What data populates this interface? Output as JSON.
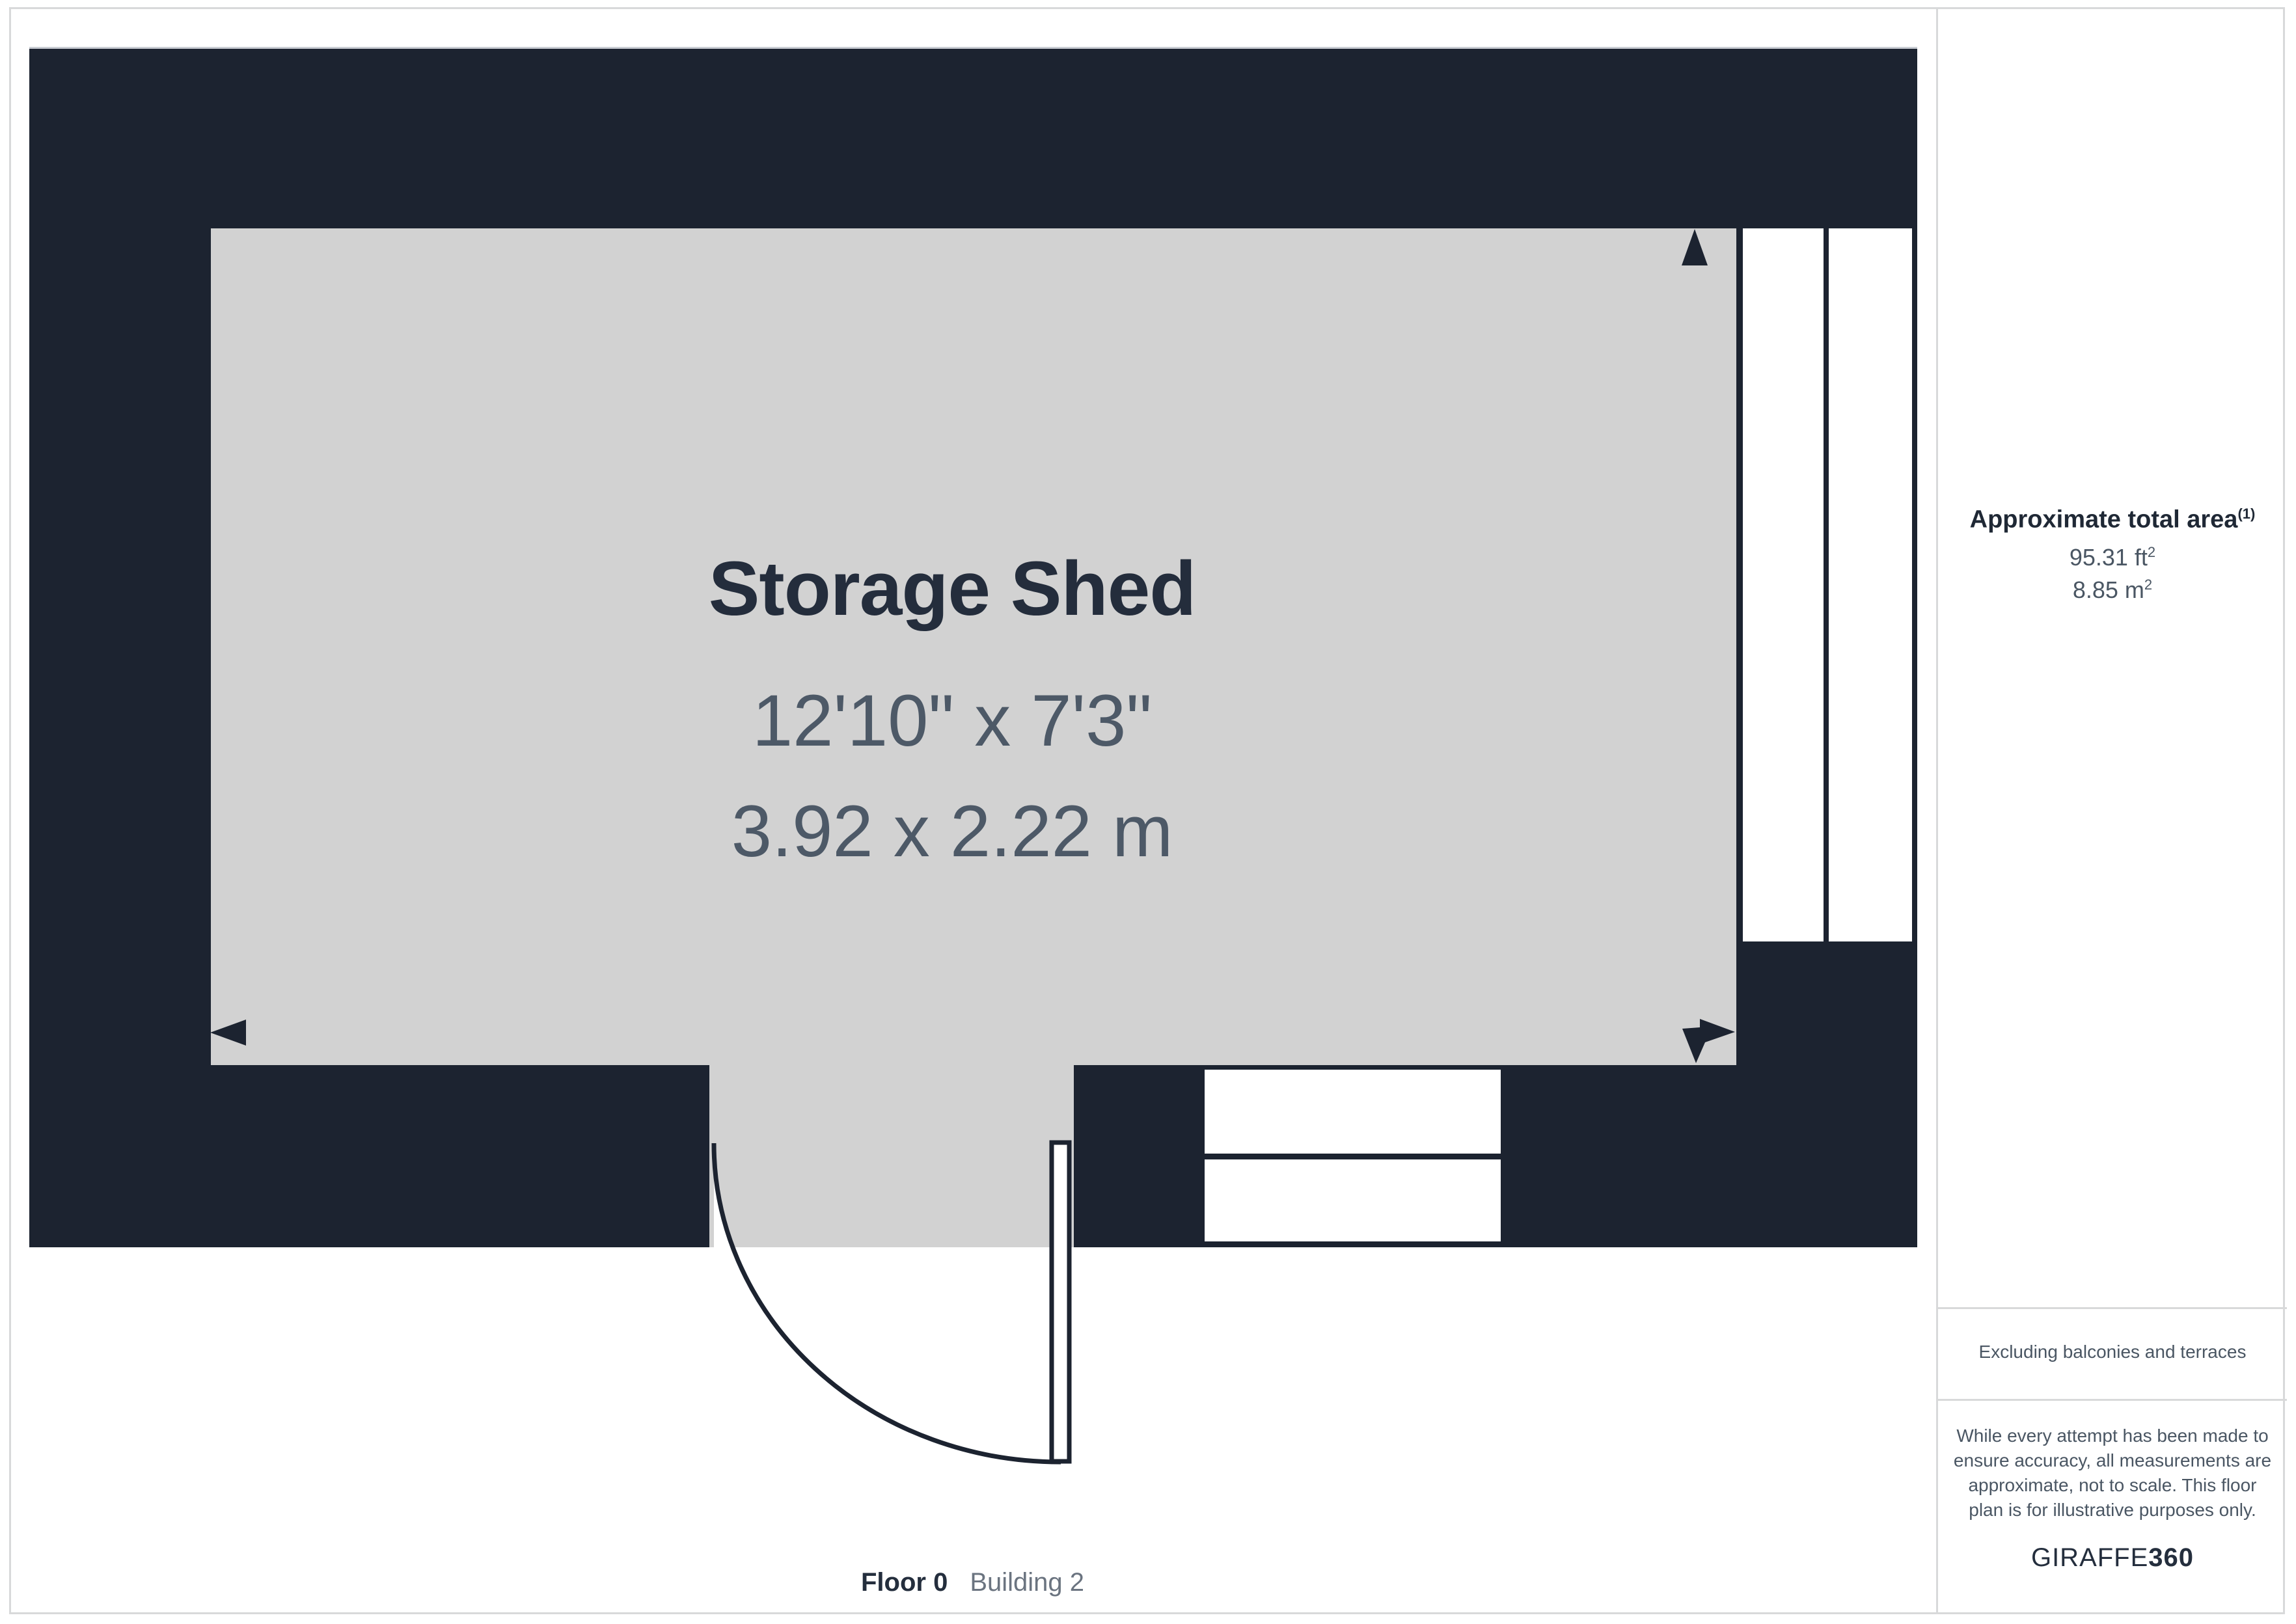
{
  "room": {
    "name": "Storage Shed",
    "size_imperial": "12'10\" x 7'3\"",
    "size_metric": "3.92 x 2.22 m"
  },
  "footer": {
    "floor": "Floor 0",
    "building": "Building 2"
  },
  "sidebar": {
    "area_title": "Approximate total area",
    "area_footnote_marker": "(1)",
    "area_imperial": "95.31 ft",
    "area_imperial_sup": "2",
    "area_metric": "8.85 m",
    "area_metric_sup": "2",
    "exclusion_note": "Excluding balconies and terraces",
    "disclaimer_lines": [
      "While every attempt has been made to",
      "ensure accuracy, all measurements are",
      "approximate, not to scale. This floor",
      "plan is for illustrative purposes only."
    ],
    "brand_name": "GIRAFFE",
    "brand_suffix": "360"
  },
  "colors": {
    "wall": "#1C2330",
    "floor_fill": "#D2D2D2",
    "frame_border": "#D8D9DA",
    "room_title_text": "#242D3C",
    "dimension_text": "#4D5967",
    "sidebar_heading_text": "#1F2835",
    "sidebar_body_text": "#4A5663",
    "footer_floor_text": "#242E3D",
    "footer_building_text": "#6B7480"
  }
}
